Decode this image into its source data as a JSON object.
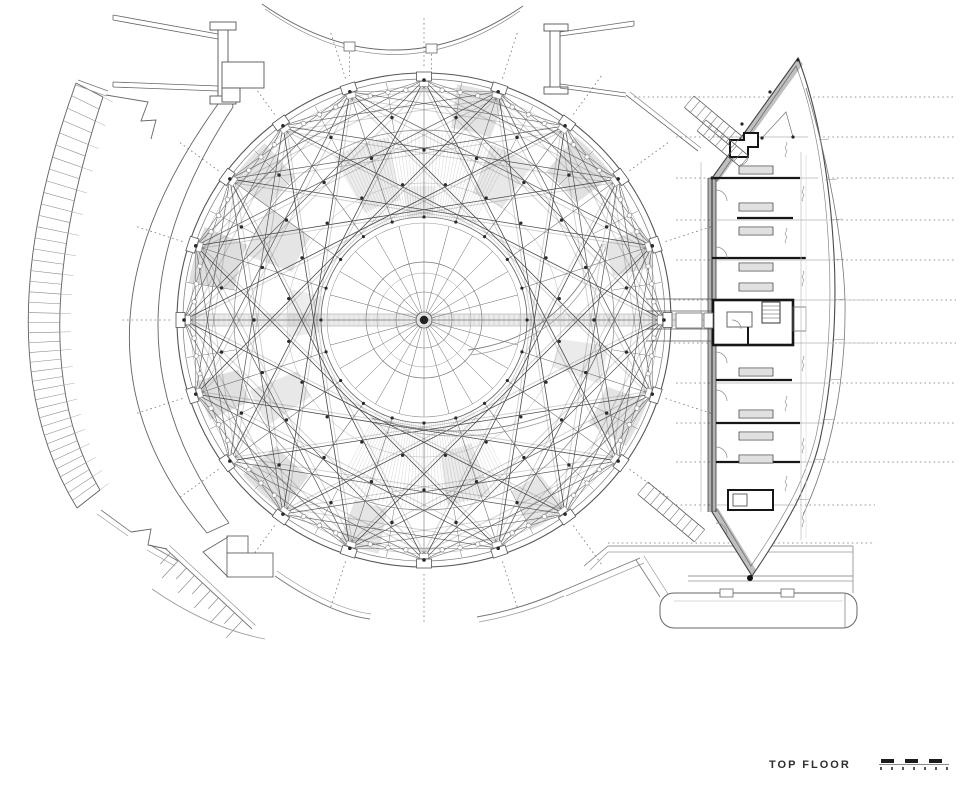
{
  "annotation": {
    "floor_label": "TOP FLOOR"
  },
  "colors": {
    "paper": "#ffffff",
    "ink": "#3f3f3f",
    "ink_bold": "#161616",
    "ink_mid": "#777777",
    "ink_light": "#aaaaaa",
    "ink_faint": "#cccccc"
  },
  "dome": {
    "center_x": 424,
    "center_y": 320,
    "outer_radius": 247,
    "ring_radius": 240,
    "core_ring_radius": 97,
    "tab_count": 20,
    "core_spoke_count": 24,
    "star_steps": [
      2,
      3,
      5,
      7
    ]
  },
  "scale_bar": {
    "top_segments": 3,
    "tick_count": 7
  }
}
